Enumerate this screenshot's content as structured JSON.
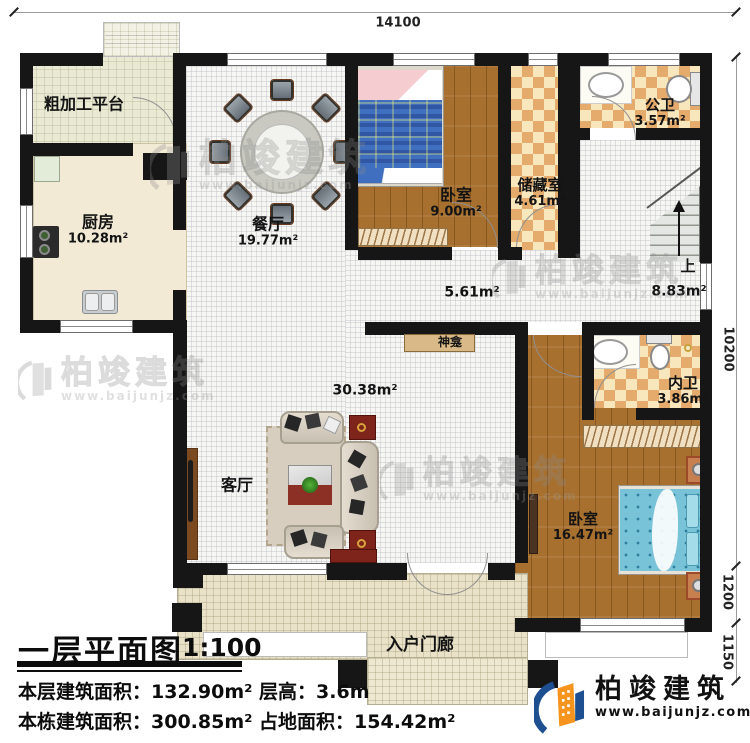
{
  "plan": {
    "dim_top": "14100",
    "dim_right_top": "10200",
    "dim_right_mid": "1200",
    "dim_right_bottom": "1150",
    "rooms": {
      "platform": {
        "name": "粗加工平台"
      },
      "kitchen": {
        "name": "厨房",
        "area": "10.28m²"
      },
      "dining": {
        "name": "餐厅",
        "area": "19.77m²"
      },
      "bedroom_top": {
        "name": "卧室",
        "area": "9.00m²"
      },
      "storage": {
        "name": "储藏室",
        "area": "4.61m²"
      },
      "public_bath": {
        "name": "公卫",
        "area": "3.57m²"
      },
      "stairs": {
        "up_label": "上",
        "area": "8.83m²"
      },
      "hall": {
        "area": "5.61m²"
      },
      "shrine": {
        "name": "神龛"
      },
      "living": {
        "name": "客厅",
        "area": "30.38m²"
      },
      "inner_bath": {
        "name": "内卫",
        "area": "3.86m²"
      },
      "bedroom_main": {
        "name": "卧室",
        "area": "16.47m²"
      },
      "porch": {
        "name": "入户门廊"
      }
    }
  },
  "title_block": {
    "title": "一层平面图",
    "scale": "1:100",
    "line1": "本层建筑面积：132.90m²  层高：3.6m",
    "line2": "本栋建筑面积：300.85m²  占地面积：154.42m²"
  },
  "brand": {
    "name": "柏竣建筑",
    "url": "www.baijunjz.com"
  },
  "watermark": {
    "name": "柏竣建筑",
    "url": "www.baijunjz.com"
  },
  "colors": {
    "wall": "#161616",
    "wood": "#a8702f",
    "checker": "#e5ab6d",
    "brand_blue": "#1d4f91",
    "brand_orange": "#f7941d"
  }
}
